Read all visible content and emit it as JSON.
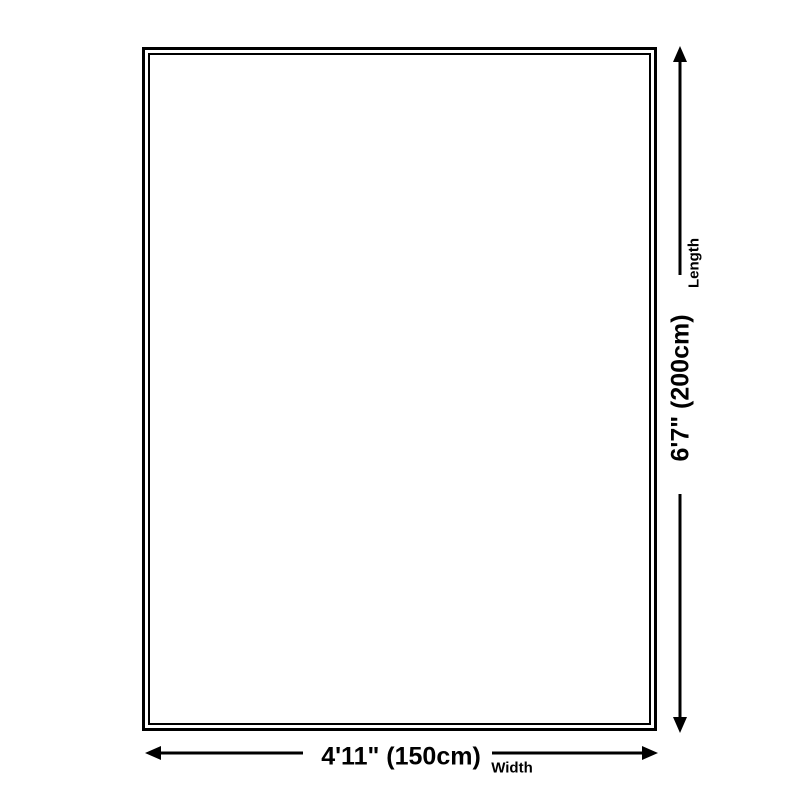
{
  "diagram": {
    "kind": "product-dimension-diagram"
  },
  "dimensions": {
    "length": {
      "value": "6'7\" (200cm)",
      "label": "Length"
    },
    "width": {
      "value": "4'11\" (150cm)",
      "label": "Width"
    }
  },
  "icons": {
    "length_arrow": "double-headed-vertical-arrow",
    "width_arrow": "double-headed-horizontal-arrow"
  },
  "colors": {
    "line": "#000000",
    "text": "#000000",
    "background": "#ffffff"
  }
}
